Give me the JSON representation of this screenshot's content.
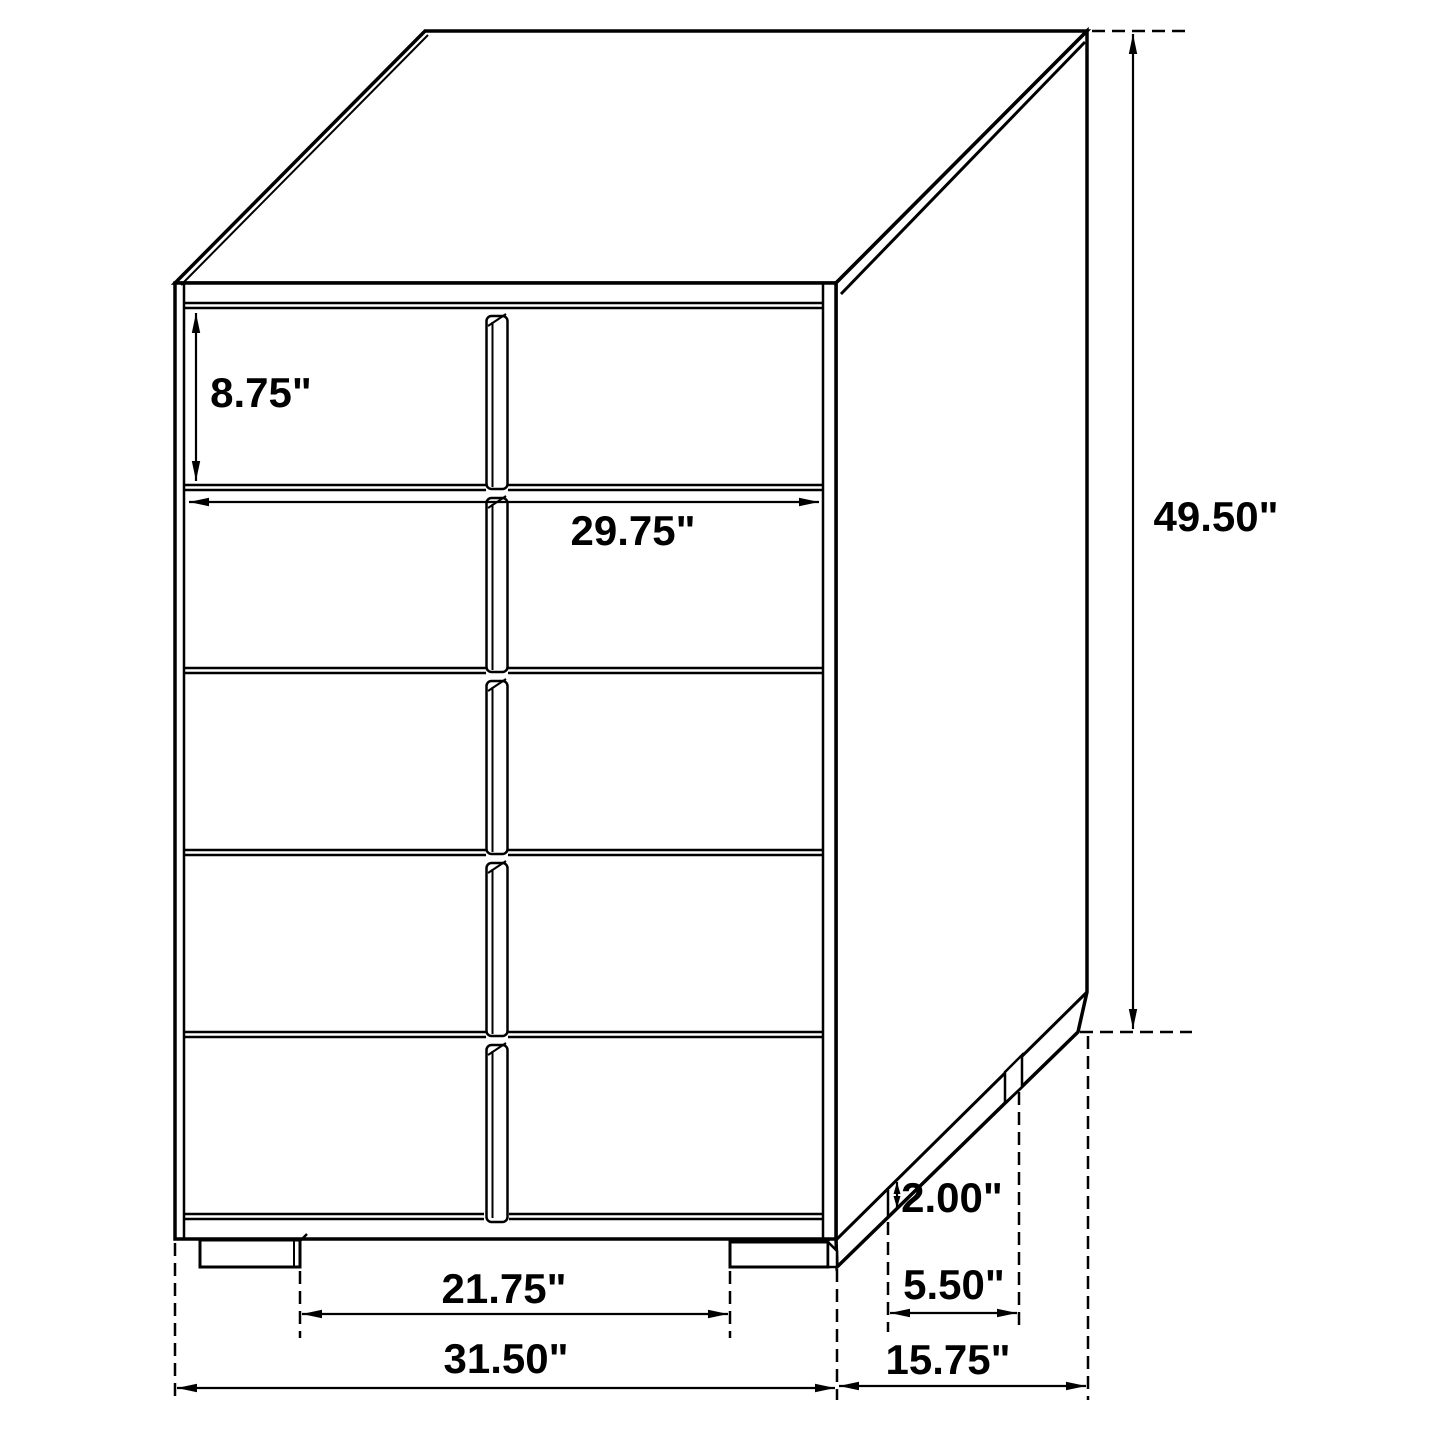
{
  "title": "Chest of drawers dimension diagram",
  "unit": "inches",
  "style": {
    "line_color": "#000000",
    "background": "#ffffff",
    "text_color": "#000000"
  },
  "figure": {
    "drawer_count": 5,
    "view": "three-quarter front-right isometric line drawing"
  },
  "dimensions": {
    "drawer_height": {
      "label": "8.75\"",
      "meaning": "top drawer front height"
    },
    "drawer_width": {
      "label": "29.75\"",
      "meaning": "drawer front width"
    },
    "overall_height": {
      "label": "49.50\"",
      "meaning": "overall height"
    },
    "leg_height": {
      "label": "2.00\"",
      "meaning": "leg / base height"
    },
    "leg_setback": {
      "label": "5.50\"",
      "meaning": "side leg spacing"
    },
    "front_leg_clearance": {
      "label": "21.75\"",
      "meaning": "clearance between front legs"
    },
    "overall_width": {
      "label": "31.50\"",
      "meaning": "overall width"
    },
    "overall_depth": {
      "label": "15.75\"",
      "meaning": "overall depth"
    }
  }
}
